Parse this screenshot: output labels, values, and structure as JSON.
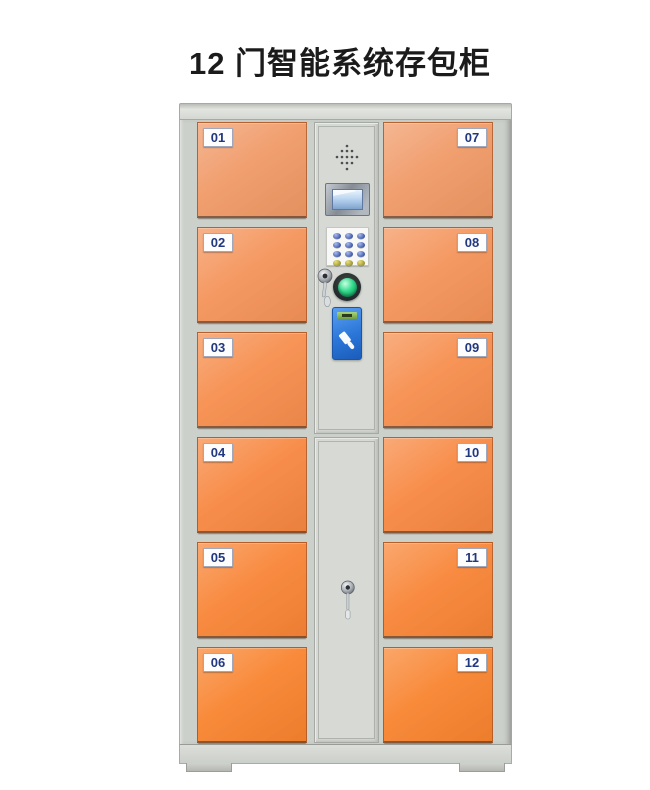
{
  "page": {
    "title": "12 门智能系统存包柜"
  },
  "locker": {
    "name": "12-door smart storage locker",
    "left_doors": [
      {
        "number": "01"
      },
      {
        "number": "02"
      },
      {
        "number": "03"
      },
      {
        "number": "04"
      },
      {
        "number": "05"
      },
      {
        "number": "06"
      }
    ],
    "right_doors": [
      {
        "number": "07"
      },
      {
        "number": "08"
      },
      {
        "number": "09"
      },
      {
        "number": "10"
      },
      {
        "number": "11"
      },
      {
        "number": "12"
      }
    ],
    "control_panel": {
      "components": [
        "speaker-grill",
        "lcd-display",
        "numeric-keypad",
        "key-lock",
        "green-button",
        "card-reader"
      ]
    }
  },
  "theme": {
    "background": "#ffffff",
    "title_color": "#1b1b1b",
    "frame_gray": "#ccd0cb",
    "panel_gray": "#d6d9d4",
    "door_number_color": "#21377f",
    "green_button": "#2fd98a",
    "card_reader_blue": "#2a76d8",
    "lcd_blue": "#bcd6f1",
    "door_orange_rows": [
      "#f09a68",
      "#f4945b",
      "#f68e4e",
      "#f78842",
      "#f88537",
      "#f88430"
    ]
  }
}
